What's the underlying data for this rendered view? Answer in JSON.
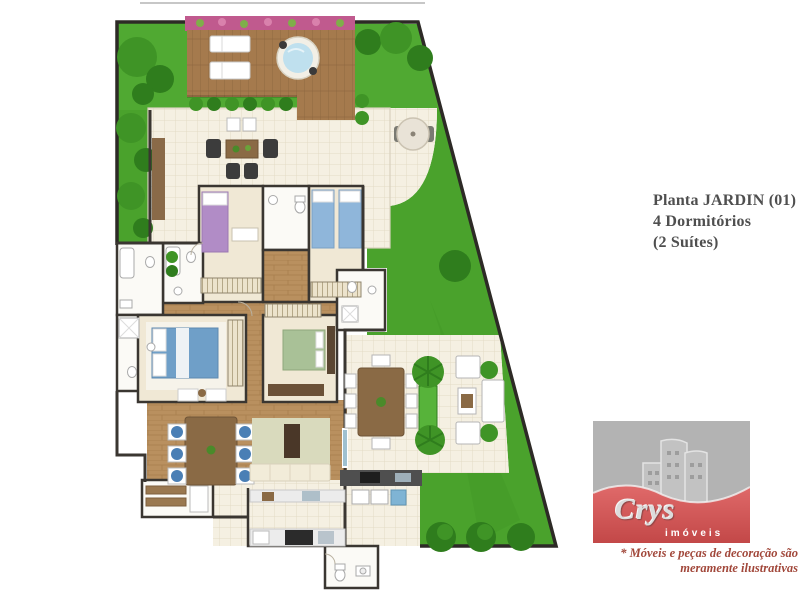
{
  "title_block": {
    "line1": "Planta JARDIN (01)",
    "line2": "4 Dormitórios",
    "line3": "(2 Suítes)"
  },
  "logo": {
    "brand": "Crys",
    "subtitle": "imóveis"
  },
  "disclaimer": {
    "line1": "* Móveis e peças de decoração são",
    "line2": "meramente ilustrativas"
  },
  "floor_plan": {
    "type": "residential-floor-plan-top-view",
    "features": [
      "garden",
      "wood-deck",
      "sun-loungers",
      "jacuzzi",
      "flower-bed",
      "hedges",
      "trees",
      "tiled-terrace",
      "parasol-table",
      "outdoor-chairs",
      "bedroom-purple",
      "bedroom-twin-blue",
      "bathrooms",
      "master-suite-blue",
      "bedroom-green",
      "suite-bathroom",
      "dining-table-blue-chairs",
      "living-room-sofa-tv",
      "kitchen",
      "pantry",
      "service-area",
      "wc",
      "gourmet-terrace",
      "outdoor-dining-table",
      "outdoor-lounge-set",
      "palm-trees",
      "lawn"
    ],
    "colors": {
      "grass": "#4aa22c",
      "grass_dark": "#2f7d1d",
      "grass_light": "#58b23a",
      "deck_wood": "#a57a4d",
      "interior_wood": "#b9905f",
      "tile_floor": "#f5f0e2",
      "wall": "#3a3631",
      "jacuzzi_water": "#bfe0ee",
      "flower_bed": "#c05a8e",
      "bed_purple": "#b18cc6",
      "bed_twin_blue": "#8fb6da",
      "bed_master_blue": "#6f9fc8",
      "bed_green": "#a9c197",
      "dining_chair_blue": "#4a7fb5",
      "logo_red": "#d85555",
      "logo_gray": "#b3b3b3",
      "disclaimer_text": "#a1473a",
      "title_text": "#4f4f4f"
    }
  }
}
